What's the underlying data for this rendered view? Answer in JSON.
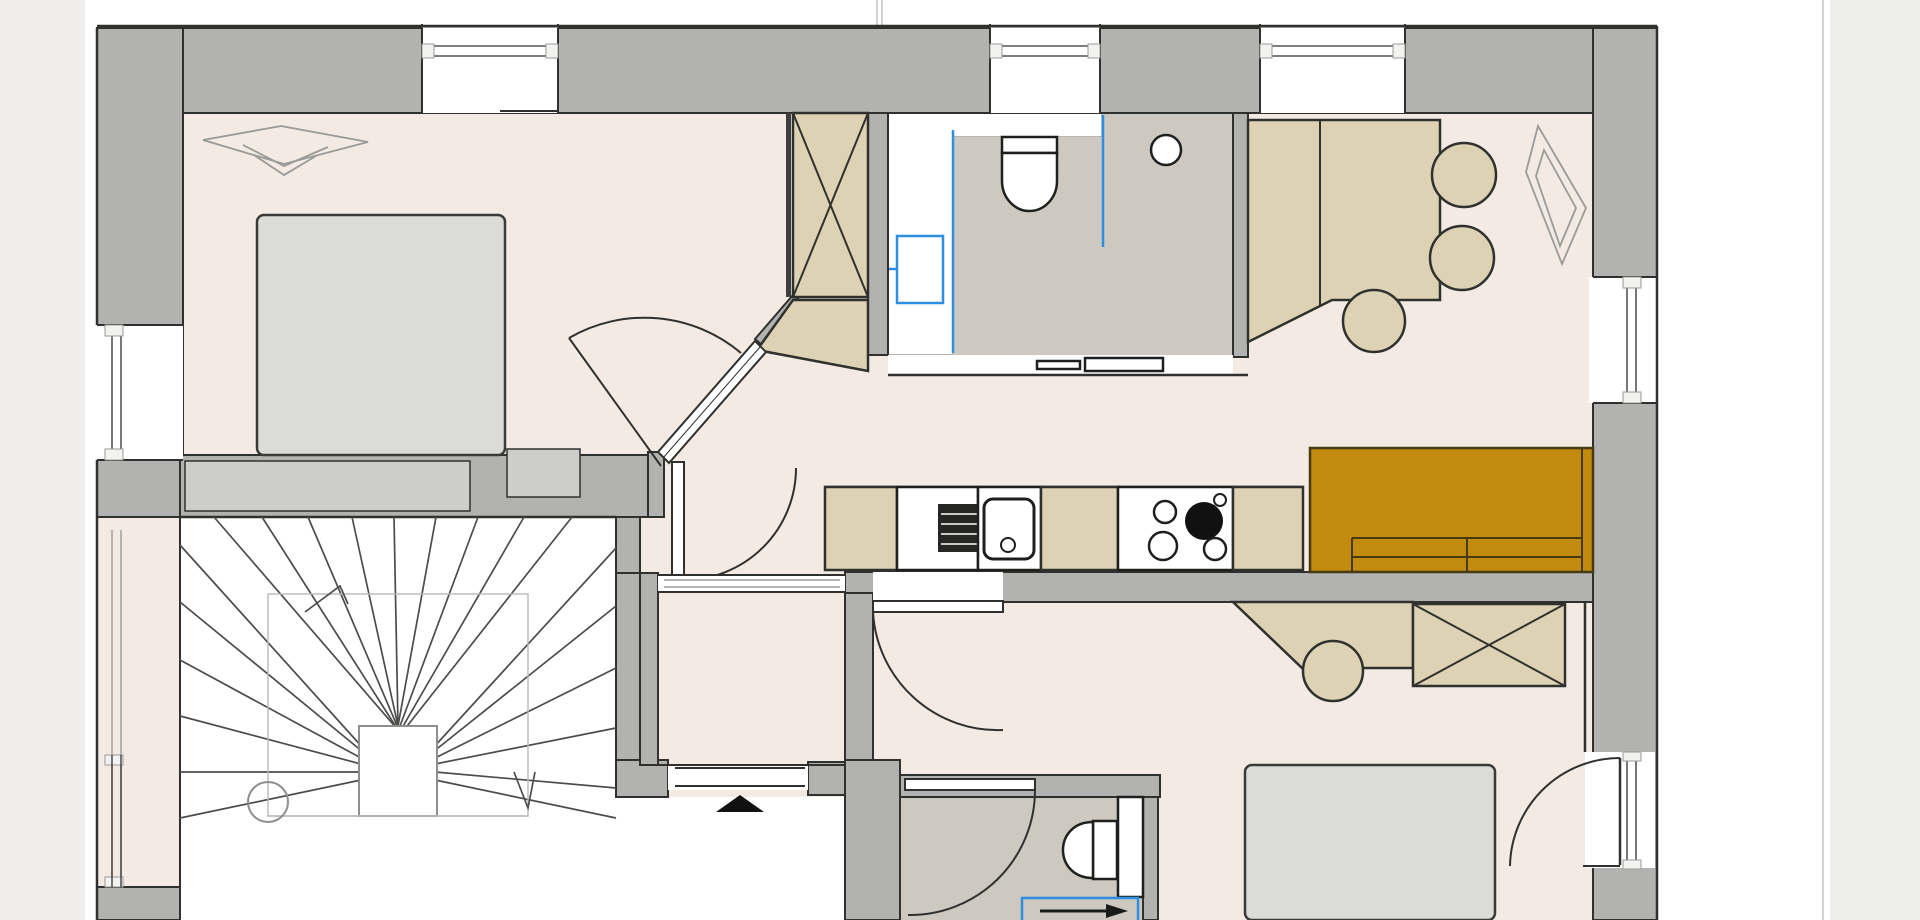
{
  "canvas": {
    "width": 1920,
    "height": 920,
    "kind": "apartment-floor-plan"
  },
  "colors": {
    "wall": "#b2b2b0",
    "wallLight": "#cdcdcb",
    "ink": "#30302e",
    "floor": "#f3eae3",
    "bathFloor": "#cdc9c1",
    "tan": "#ddd3b4",
    "bed": "#dbdbd9",
    "sofa": "#c28b0e",
    "blue": "#2e8fe2",
    "lineLight": "#9a9a98",
    "guide": "#b9b9b7",
    "marginLeft": "#efeeec",
    "marginRight": "#ededeb"
  },
  "rooms": [
    {
      "name": "bedroom-1"
    },
    {
      "name": "closet-hall"
    },
    {
      "name": "bathroom-1"
    },
    {
      "name": "dining-area"
    },
    {
      "name": "kitchen"
    },
    {
      "name": "stairwell"
    },
    {
      "name": "entry-vestibule"
    },
    {
      "name": "corridor"
    },
    {
      "name": "bedroom-2"
    },
    {
      "name": "shower-room"
    }
  ],
  "fixtures": [
    {
      "name": "ceiling-lamp"
    },
    {
      "name": "double-bed"
    },
    {
      "name": "wardrobe-crossed"
    },
    {
      "name": "washbasin"
    },
    {
      "name": "toilet"
    },
    {
      "name": "shower-glass"
    },
    {
      "name": "extractor-light"
    },
    {
      "name": "dining-table"
    },
    {
      "name": "chair"
    },
    {
      "name": "pendant-lamp"
    },
    {
      "name": "kitchen-sink"
    },
    {
      "name": "dishwasher"
    },
    {
      "name": "cooktop"
    },
    {
      "name": "sofa"
    },
    {
      "name": "staircase"
    },
    {
      "name": "stair-direction-arrow"
    },
    {
      "name": "entrance-arrow"
    },
    {
      "name": "desk"
    },
    {
      "name": "stool"
    },
    {
      "name": "radiator"
    },
    {
      "name": "balcony-door"
    },
    {
      "name": "window"
    }
  ]
}
